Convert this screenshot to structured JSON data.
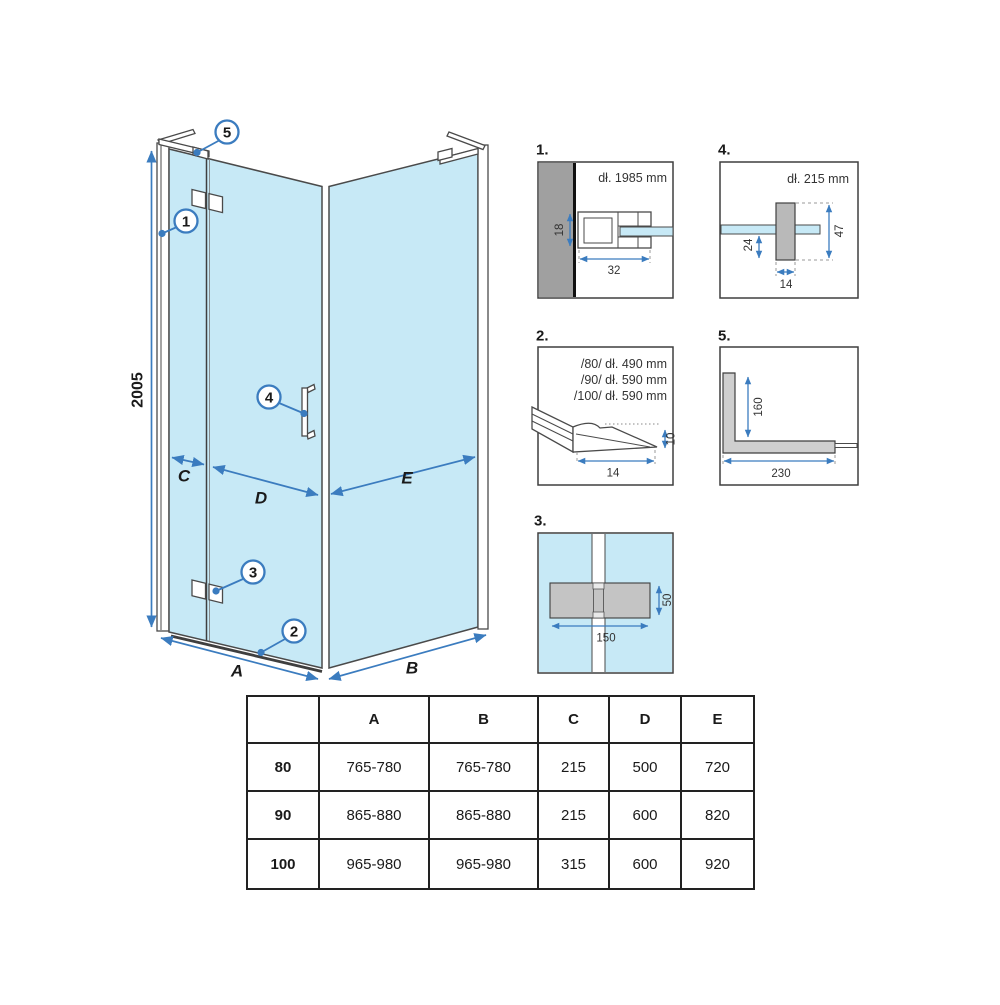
{
  "colors": {
    "glass_blue": "#c7e9f6",
    "accent_blue": "#3b7cbf",
    "outline_dark": "#3f3f3f",
    "wall_gray": "#a0a0a0",
    "hinge_gray": "#c4c4c4"
  },
  "diagram": {
    "height_label": "2005",
    "dims": {
      "A": "A",
      "B": "B",
      "C": "C",
      "D": "D",
      "E": "E"
    },
    "callouts": {
      "c1": "1",
      "c2": "2",
      "c3": "3",
      "c4": "4",
      "c5": "5"
    }
  },
  "details": {
    "d1": {
      "label": "1.",
      "length_note": "dł. 1985 mm",
      "dim_depth": "18",
      "dim_width": "32"
    },
    "d2": {
      "label": "2.",
      "length_notes": [
        "/80/ dł. 490 mm",
        "/90/ dł. 590 mm",
        "/100/ dł. 590 mm"
      ],
      "dim_width": "14",
      "dim_height": "10"
    },
    "d3": {
      "label": "3.",
      "dim_width": "150",
      "dim_height": "50"
    },
    "d4": {
      "label": "4.",
      "length_note": "dł. 215 mm",
      "dim_offset": "24",
      "dim_height": "47",
      "dim_width": "14"
    },
    "d5": {
      "label": "5.",
      "dim_vertical": "160",
      "dim_horizontal": "230"
    }
  },
  "table": {
    "headers": {
      "A": "A",
      "B": "B",
      "C": "C",
      "D": "D",
      "E": "E"
    },
    "rows": [
      {
        "label": "80",
        "A": "765-780",
        "B": "765-780",
        "C": "215",
        "D": "500",
        "E": "720"
      },
      {
        "label": "90",
        "A": "865-880",
        "B": "865-880",
        "C": "215",
        "D": "600",
        "E": "820"
      },
      {
        "label": "100",
        "A": "965-980",
        "B": "965-980",
        "C": "315",
        "D": "600",
        "E": "920"
      }
    ]
  }
}
